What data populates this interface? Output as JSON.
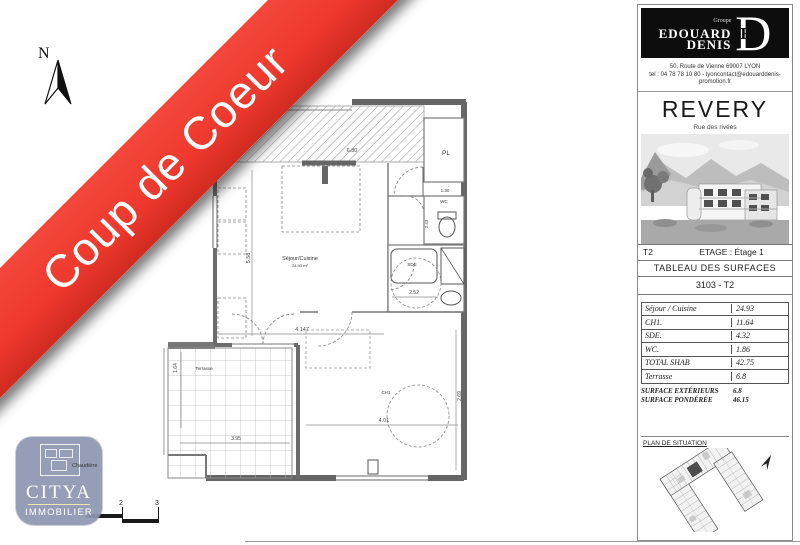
{
  "banner": {
    "label": "Coup de Coeur",
    "color": "#ee382d"
  },
  "compass": {
    "label": "N"
  },
  "agency": {
    "name": "CITYA",
    "line2": "IMMOBILIER"
  },
  "plan_annotation": "Chaudière",
  "scalebar": {
    "ticks": [
      "2",
      "3"
    ]
  },
  "sidebar": {
    "brand": {
      "group": "Groupe",
      "name_line1": "EDOUARD",
      "name_line2": "DENIS",
      "monogram": "D",
      "monogram_inner": "E"
    },
    "address_line1": "50, Route de Vienne 69007 LYON",
    "address_line2": "tel : 04 78 78 10 80 - lyoncontact@edouarddenis-",
    "address_line3": "promotion.fr",
    "program_name": "REVERY",
    "program_subtitle": "Rue des rivées",
    "unit_type": "T2",
    "floor_label": "ETAGE : Étage 1",
    "table_title": "TABLEAU DES SURFACES",
    "lot_ref": "3103 - T2",
    "surfaces": [
      {
        "label": "Séjour / Cuisine",
        "value": "24.93"
      },
      {
        "label": "CH1.",
        "value": "11.64"
      },
      {
        "label": "SDE.",
        "value": "4.32"
      },
      {
        "label": "WC.",
        "value": "1.86"
      },
      {
        "label": "TOTAL SHAB",
        "value": "42.75"
      },
      {
        "label": "Terrasse",
        "value": "6.8"
      }
    ],
    "summary": [
      {
        "label": "SURFACE EXTÉRIEURS",
        "value": "6.8"
      },
      {
        "label": "SURFACE PONDÉRÉE",
        "value": "46.15"
      }
    ],
    "situation_title": "PLAN DE SITUATION"
  },
  "floorplan": {
    "rooms": [
      {
        "text": "Séjour/Cuisine",
        "x": 300,
        "y": 260,
        "size": 5.5
      },
      {
        "text": "24.93 m²",
        "x": 300,
        "y": 267,
        "size": 4
      },
      {
        "text": "PL",
        "x": 446,
        "y": 155,
        "size": 6.5
      },
      {
        "text": "WC",
        "x": 444,
        "y": 203,
        "size": 4.5
      },
      {
        "text": "SDE",
        "x": 412,
        "y": 266,
        "size": 4.5
      },
      {
        "text": "CH1",
        "x": 386,
        "y": 394,
        "size": 4.5
      },
      {
        "text": "Terrasse",
        "x": 204,
        "y": 370,
        "size": 4.5
      }
    ],
    "dims": [
      {
        "text": "6.80",
        "x": 352,
        "y": 152,
        "size": 5.5
      },
      {
        "text": "5.58",
        "x": 250,
        "y": 258,
        "size": 5.5,
        "rotate": -90
      },
      {
        "text": "4.147",
        "x": 302,
        "y": 331,
        "size": 5.5
      },
      {
        "text": "2.52",
        "x": 414,
        "y": 294,
        "size": 5
      },
      {
        "text": "4.01",
        "x": 384,
        "y": 422,
        "size": 5.5
      },
      {
        "text": "2.69",
        "x": 461,
        "y": 396,
        "size": 5,
        "rotate": -90
      },
      {
        "text": "1.64",
        "x": 177,
        "y": 368,
        "size": 5,
        "rotate": -90
      },
      {
        "text": "3.95",
        "x": 236,
        "y": 440,
        "size": 5
      },
      {
        "text": "1.30",
        "x": 445,
        "y": 192,
        "size": 4.5
      },
      {
        "text": "2.43",
        "x": 428,
        "y": 224,
        "size": 4.5,
        "rotate": -90
      }
    ]
  }
}
